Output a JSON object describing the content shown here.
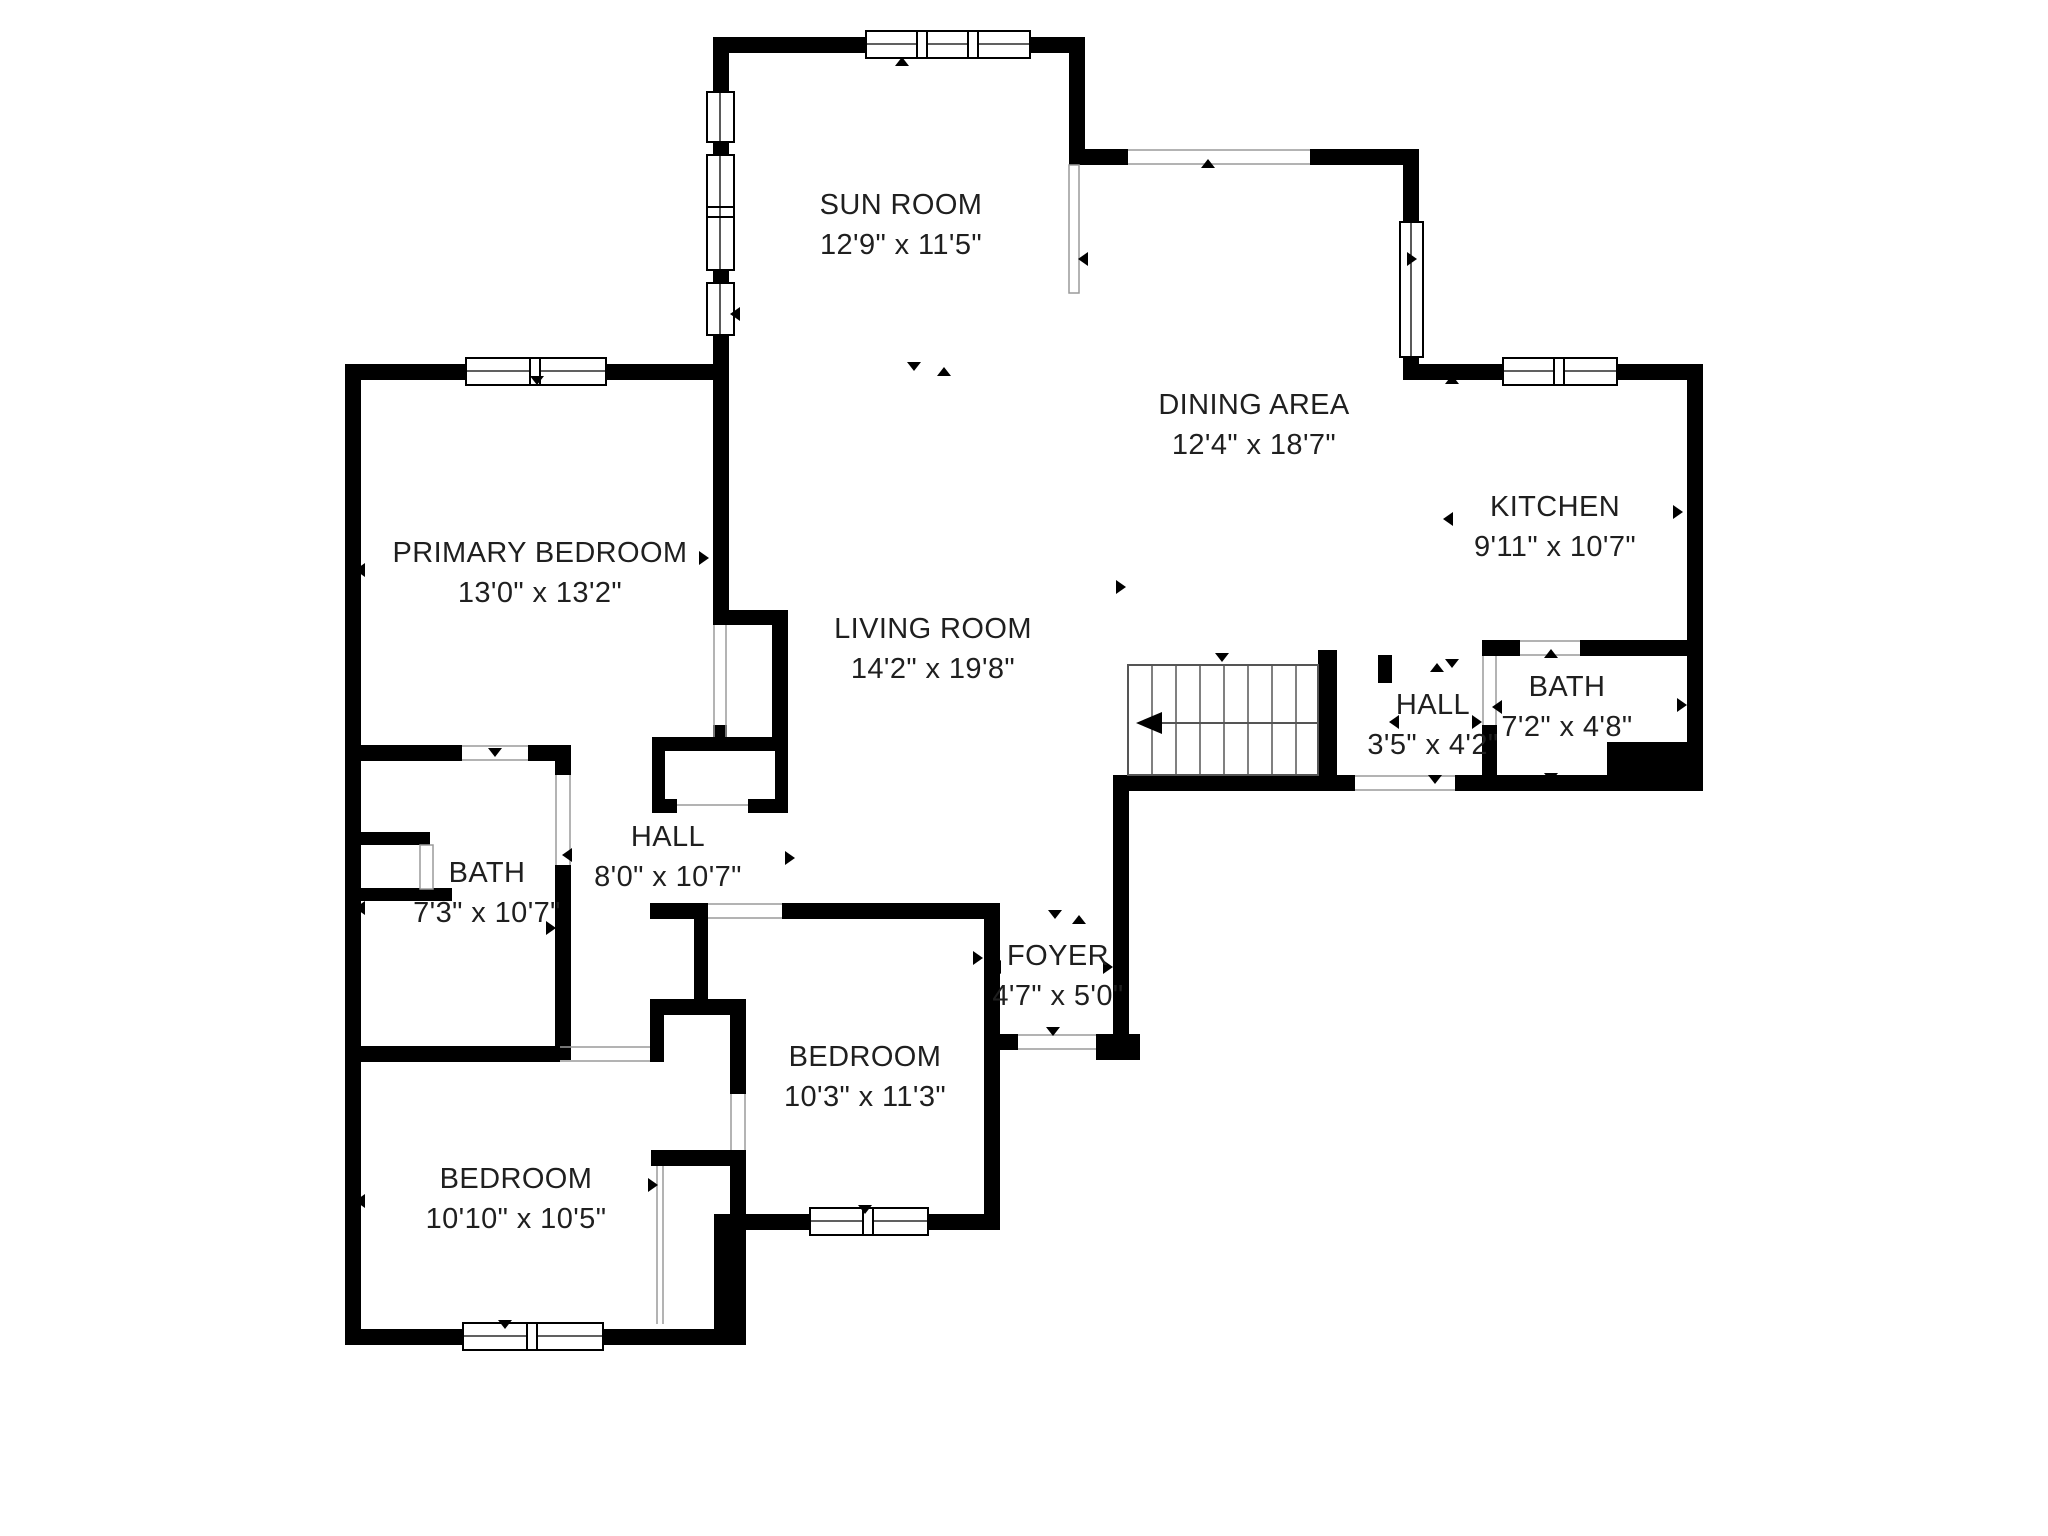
{
  "plan": {
    "title": "Floor plan",
    "background": "#ffffff",
    "wall_color": "#000000",
    "text_color": "#1f1f1f",
    "stairs_direction": "left"
  },
  "rooms": [
    {
      "id": "sun-room",
      "name": "SUN ROOM",
      "dims": "12'9\" x 11'5\""
    },
    {
      "id": "dining-area",
      "name": "DINING AREA",
      "dims": "12'4\" x 18'7\""
    },
    {
      "id": "kitchen",
      "name": "KITCHEN",
      "dims": "9'11\" x 10'7\""
    },
    {
      "id": "primary-bedroom",
      "name": "PRIMARY BEDROOM",
      "dims": "13'0\" x 13'2\""
    },
    {
      "id": "living-room",
      "name": "LIVING ROOM",
      "dims": "14'2\" x 19'8\""
    },
    {
      "id": "hall-upper",
      "name": "HALL",
      "dims": "3'5\" x 4'2\""
    },
    {
      "id": "bath-upper",
      "name": "BATH",
      "dims": "7'2\" x 4'8\""
    },
    {
      "id": "bath-lower",
      "name": "BATH",
      "dims": "7'3\" x 10'7\""
    },
    {
      "id": "hall-lower",
      "name": "HALL",
      "dims": "8'0\" x 10'7\""
    },
    {
      "id": "foyer",
      "name": "FOYER",
      "dims": "4'7\" x 5'0\""
    },
    {
      "id": "bedroom-middle",
      "name": "BEDROOM",
      "dims": "10'3\" x 11'3\""
    },
    {
      "id": "bedroom-lower",
      "name": "BEDROOM",
      "dims": "10'10\" x 10'5\""
    }
  ]
}
